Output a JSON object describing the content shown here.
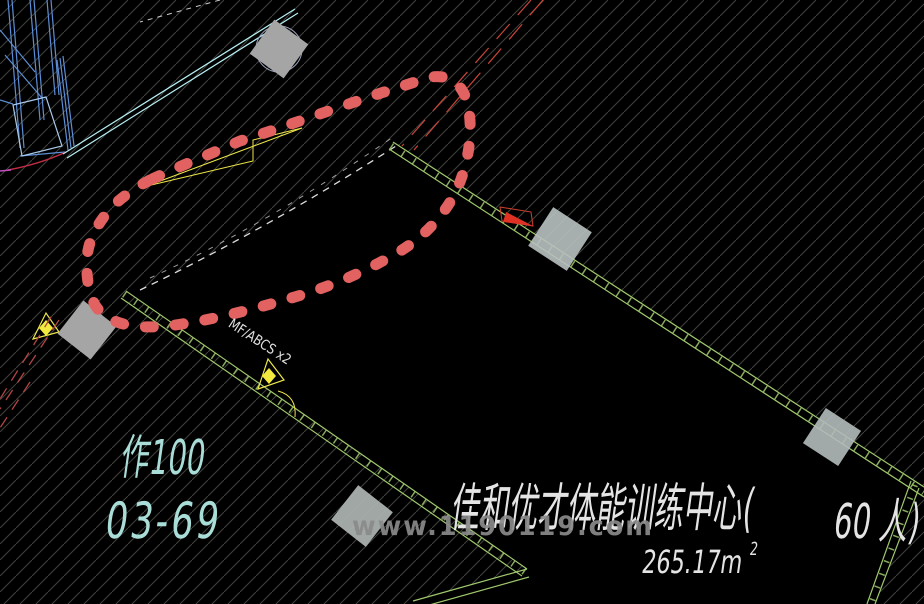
{
  "app": {
    "view": "cad-floor-plan-canvas"
  },
  "texts": {
    "room_title": "佳和优才体能训练中心(",
    "room_capacity": "60 人)",
    "room_area": "265.17m",
    "room_area_superscript": "2",
    "plan_code_line1": "作100",
    "plan_code_line2": "03-69",
    "door_tag": "MF/ABCS x2",
    "watermark": "www.1190119.com"
  },
  "colors": {
    "background": "#000000",
    "hatch_gray": "#41413d",
    "wall_green": "#9fc86d",
    "highlight_red": "#e26161",
    "leader_red": "#c8453a",
    "arrow_red": "#d84632",
    "dark_red_dash": "#b24545",
    "warning_yellow": "#ece549",
    "column_gray": "#a8a8a8",
    "column_light": "#b9c1c1",
    "structure_blue": "#5d8ed6",
    "structure_cyan": "#b6eef2",
    "text_white": "#e4e4e4",
    "text_cyan": "#a9ddd8",
    "watermark_gray": "#8a8a8a",
    "magenta": "#c050c0",
    "crimson": "#c22e44"
  }
}
